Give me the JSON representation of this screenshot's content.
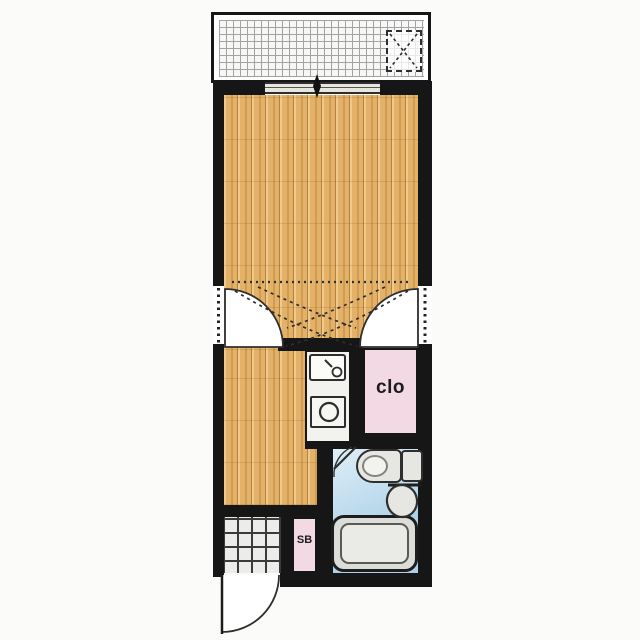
{
  "labels": {
    "closet": "clo",
    "shoe_box": "SB"
  },
  "icons": {
    "washer_space": "dashed-square-with-x",
    "sliding_window_marker": "black-diamond",
    "kitchen_faucet": "circle-with-spout",
    "stove_burner": "circle",
    "door_swings": "quarter-arc"
  },
  "colors": {
    "bg": "#fbfbfa",
    "white": "#ffffff",
    "wall": "#161616",
    "outline": "#2e2e2e",
    "wood_light": "#f0ca8a",
    "wood_mid": "#e3b168",
    "wood_dark": "#cf9c52",
    "wood_seam": "#b5823d",
    "balcony_line": "#a3a3a3",
    "tile_bg": "#f7f7f5",
    "entrance_line": "#3a3a3a",
    "entrance_tile": "#ececea",
    "pink": "#f2d9e4",
    "label_dark": "#1c1c1c",
    "bath_blue_1": "#e1f0f8",
    "bath_blue_2": "#abd0e7",
    "fixture_fill": "#e6e6e2",
    "fixture_inner": "#f2f2ef"
  }
}
